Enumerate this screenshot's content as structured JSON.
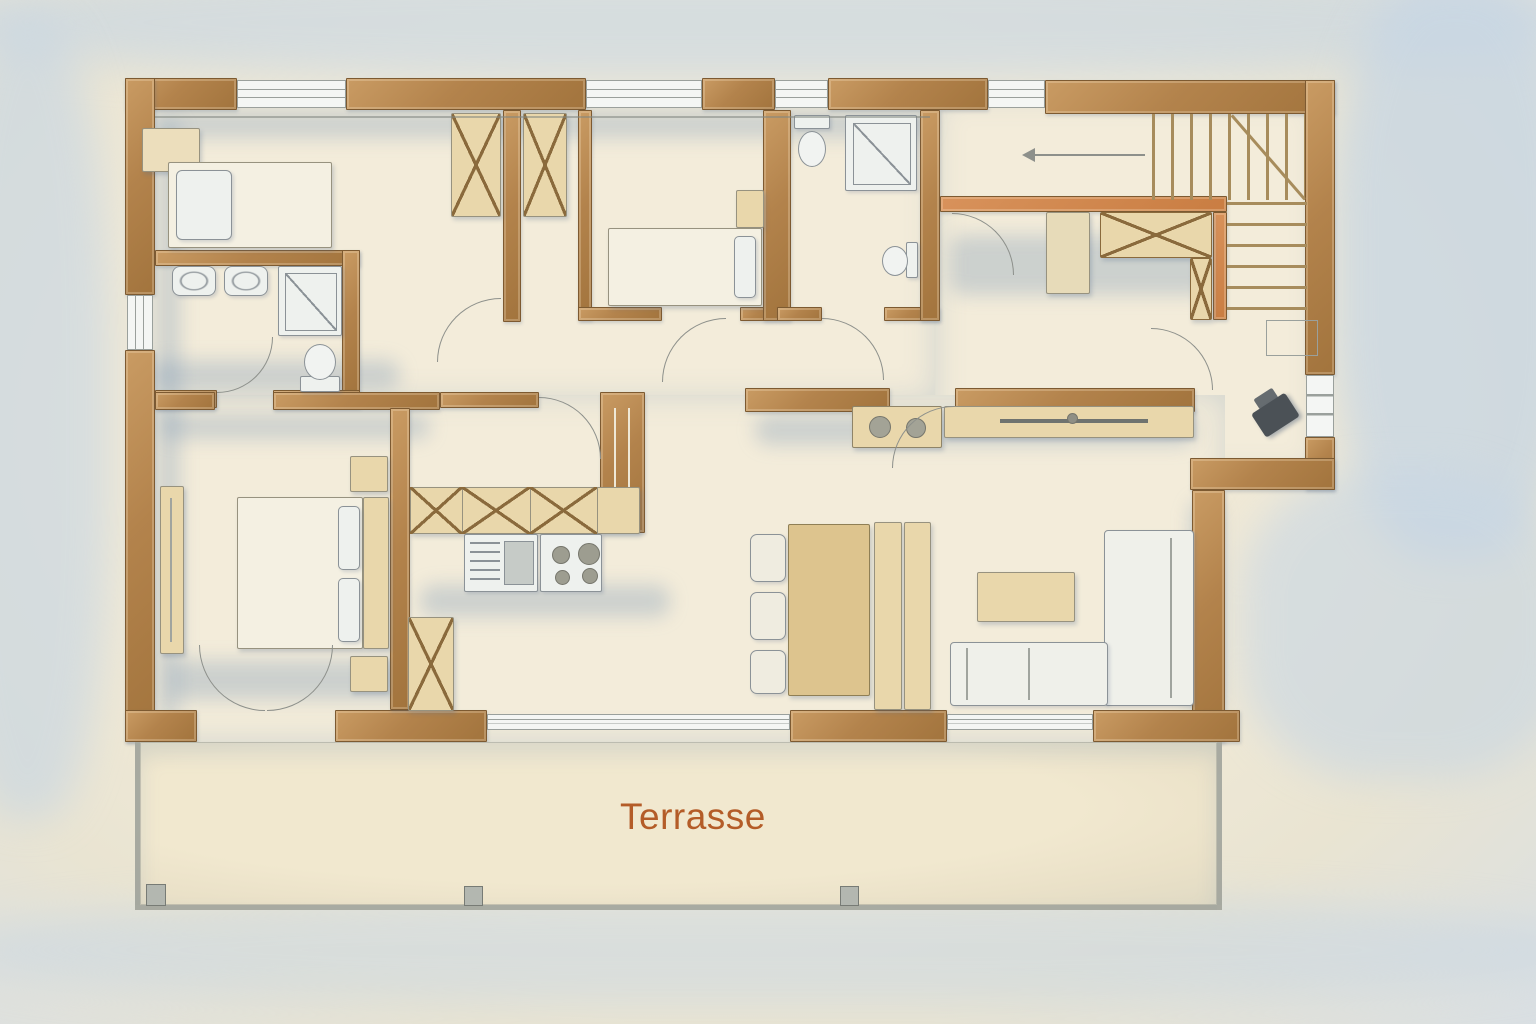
{
  "labels": {
    "terrace": "Terrasse"
  },
  "palette": {
    "paper": "#f0e9d6",
    "wash": "#c7d6e4",
    "wall": "#b3834c",
    "wall_light": "#c99b63",
    "wall_edge": "#7d5a31",
    "wall_accent": "#c97d42",
    "floor": "#f3ecda",
    "floor_shadow": "rgba(116,146,178,0.30)",
    "furniture": "#e9d7ab",
    "furniture_dark": "#ddc48e",
    "furniture_edge": "#97927f",
    "fixture": "#eef1ee",
    "fixture_edge": "#8b9297",
    "glass": "#f4f6f4",
    "line": "#8d908b",
    "tread": "#a78c5c",
    "terrace": "#efe7cf",
    "terrace_border": "#a2a7a3",
    "stove": "#4b5156",
    "label": "#b45c28"
  }
}
